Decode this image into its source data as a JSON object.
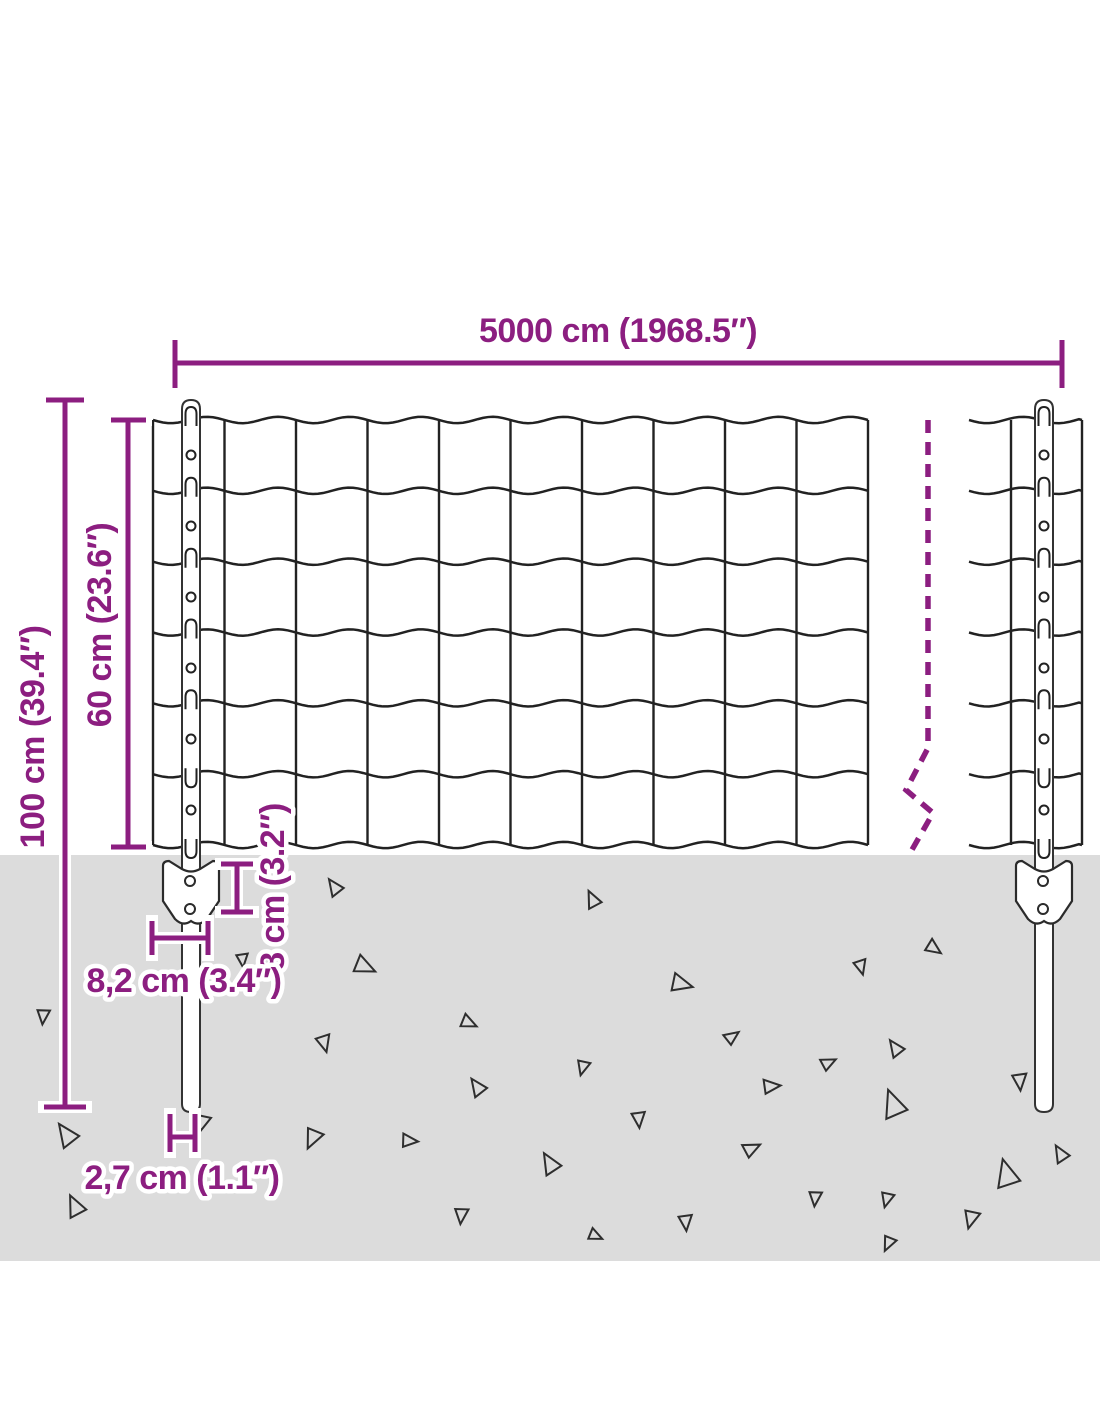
{
  "product_diagram": {
    "description": "fence-with-posts-dimension-diagram",
    "dimension_labels": {
      "total_width": "5000 cm (1968.5″)",
      "total_height": "100 cm (39.4″)",
      "fence_height": "60 cm (23.6″)",
      "anchor_height": "8 cm (3.2″)",
      "anchor_width": "8,2 cm (3.4″)",
      "post_diameter": "2,7 cm (1.1″)"
    },
    "colors": {
      "accent_purple": "#8C1E80",
      "ground_gray": "#DCDCDC",
      "wire_dark": "#222222",
      "background": "#FFFFFF"
    },
    "mesh": {
      "rows": 6,
      "columns": 10,
      "posts": 2,
      "clips_per_post": 7,
      "holes_per_post": 6
    }
  }
}
